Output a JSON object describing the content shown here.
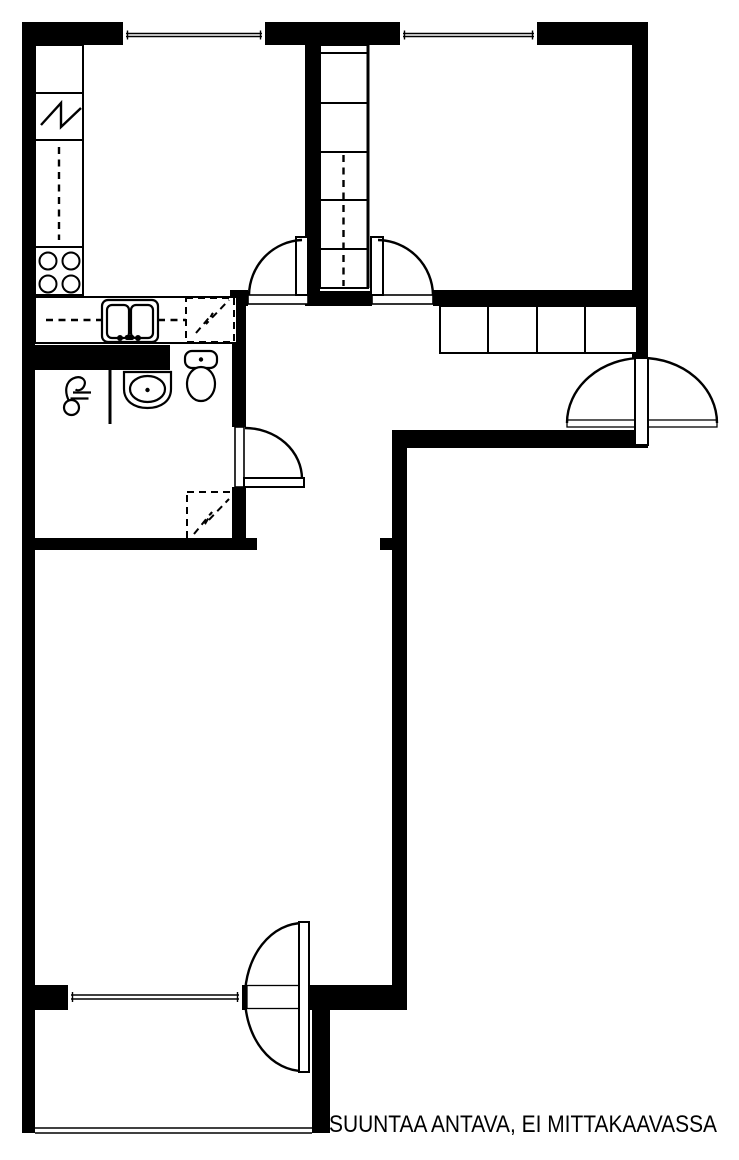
{
  "colors": {
    "ink": "#000000",
    "paper": "#ffffff"
  },
  "disclaimer": {
    "text": "SUUNTAA ANTAVA, EI MITTAKAAVASSA"
  },
  "icons": {
    "stove": "stove-burners-icon",
    "refrigerator": "refrigerator-zigzag-icon",
    "sink": "double-basin-sink-icon",
    "dishwasher_reservation": "dashed-appliance-reservation-icon",
    "washing_machine_reservation": "dashed-appliance-reservation-icon",
    "toilet": "toilet-icon",
    "washbasin": "washbasin-icon",
    "shower_drain": "shower-drain-icon",
    "wardrobe": "wardrobe-cells-icon",
    "door_swing": "door-swing-arc-icon",
    "window": "window-double-line-icon"
  }
}
